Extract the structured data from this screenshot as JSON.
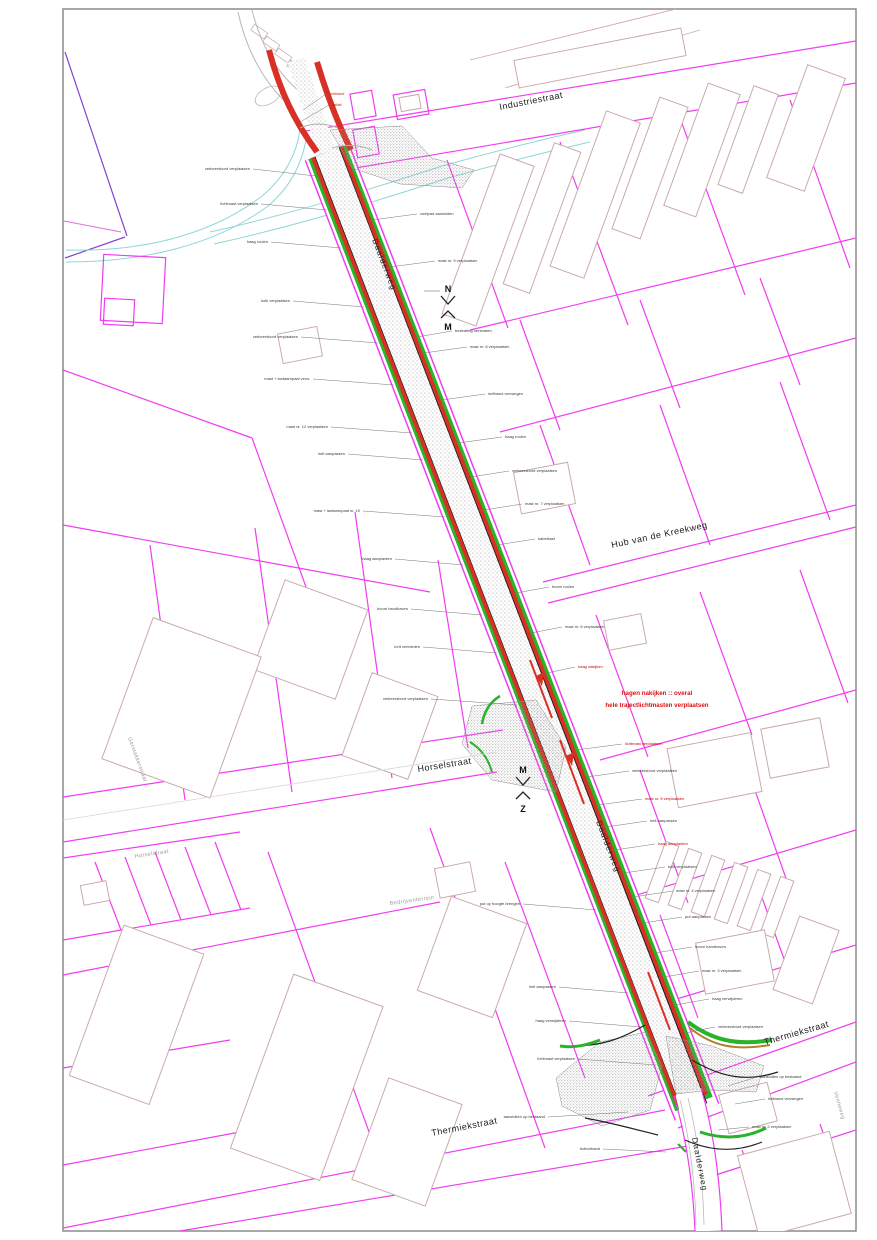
{
  "labels": {
    "industriestraat": "Industriestraat",
    "daalderweg": "Daalderweg",
    "hub_van_de_kreekweg": "Hub van de Kreekweg",
    "horselstraat": "Horselstraat",
    "horselstraat_small": "Horselstraat",
    "thermiekstraat_ne": "Thermiekstraat",
    "thermiekstraat_sw": "Thermiekstraat",
    "gerstakkerstraat": "Gerstakkerstraat",
    "bedrijventerrein": "Bedrijventerrein",
    "venneweg": "Venneweg"
  },
  "note": {
    "line1": "hagen nakijken :: overal",
    "line2": "hele trajectlichtmasten verplaatsen"
  },
  "markers": [
    {
      "top": "N",
      "bottom": "M"
    },
    {
      "top": "M",
      "bottom": "Z"
    }
  ],
  "colors": {
    "road_red": "#d93025",
    "parcel_magenta": "#f23cf2",
    "verge_green": "#2ab32a",
    "note_red": "#dd1111",
    "water_teal": "#8fd6d6",
    "building_outline": "#c9abab"
  },
  "annotations": [
    {
      "t": "verkeersbord verplaatsen",
      "x": 250,
      "y": 170,
      "lx": 316,
      "ly": 176,
      "a": "end"
    },
    {
      "t": "lichtmast verplaatsen",
      "x": 258,
      "y": 205,
      "lx": 327,
      "ly": 210,
      "a": "end"
    },
    {
      "t": "haag rooien",
      "x": 268,
      "y": 243,
      "lx": 341,
      "ly": 248,
      "a": "end"
    },
    {
      "t": "kolk verplaatsen",
      "x": 290,
      "y": 302,
      "lx": 364,
      "ly": 307,
      "a": "end"
    },
    {
      "t": "verkeersbord verplaatsen",
      "x": 298,
      "y": 338,
      "lx": 378,
      "ly": 343,
      "a": "end"
    },
    {
      "t": "mast + lantaarnpaal verw.",
      "x": 310,
      "y": 380,
      "lx": 394,
      "ly": 385,
      "a": "end"
    },
    {
      "t": "mast nr. 12 verplaatsen",
      "x": 328,
      "y": 428,
      "lx": 412,
      "ly": 433,
      "a": "end"
    },
    {
      "t": "inrit aanpassen",
      "x": 345,
      "y": 455,
      "lx": 423,
      "ly": 460,
      "a": "end"
    },
    {
      "t": "mast + lantaarnpaal nr. 10",
      "x": 360,
      "y": 512,
      "lx": 445,
      "ly": 517,
      "a": "end"
    },
    {
      "t": "haag aanplanten",
      "x": 392,
      "y": 560,
      "lx": 463,
      "ly": 565,
      "a": "end"
    },
    {
      "t": "boom handhaven",
      "x": 408,
      "y": 610,
      "lx": 482,
      "ly": 615,
      "a": "end"
    },
    {
      "t": "inrit verbreden",
      "x": 420,
      "y": 648,
      "lx": 497,
      "ly": 653,
      "a": "end"
    },
    {
      "t": "verkeersbord verplaatsen",
      "x": 428,
      "y": 700,
      "lx": 517,
      "ly": 705,
      "a": "end"
    },
    {
      "t": "put op hoogte brengen",
      "x": 520,
      "y": 905,
      "lx": 596,
      "ly": 910,
      "a": "end"
    },
    {
      "t": "inrit aanpassen",
      "x": 556,
      "y": 988,
      "lx": 628,
      "ly": 993,
      "a": "end"
    },
    {
      "t": "haag verwijderen",
      "x": 566,
      "y": 1022,
      "lx": 641,
      "ly": 1027,
      "a": "end"
    },
    {
      "t": "lichtmast verplaatsen",
      "x": 575,
      "y": 1060,
      "lx": 656,
      "ly": 1065,
      "a": "end"
    },
    {
      "t": "aansluiten op bestaand",
      "x": 545,
      "y": 1118,
      "lx": 628,
      "ly": 1112,
      "a": "end"
    },
    {
      "t": "trottoirband",
      "x": 600,
      "y": 1150,
      "lx": 666,
      "ly": 1152,
      "a": "end"
    },
    {
      "t": "inritband",
      "x": 329,
      "y": 95,
      "lx": 303,
      "ly": 110,
      "a": "start",
      "c": "#cc2200"
    },
    {
      "t": "asfalt",
      "x": 332,
      "y": 106,
      "lx": 300,
      "ly": 122,
      "a": "start",
      "c": "#cc2200"
    },
    {
      "t": "voetpad aansluiten",
      "x": 420,
      "y": 215,
      "lx": 372,
      "ly": 220,
      "a": "start"
    },
    {
      "t": "mast nr. 9 verplaatsen",
      "x": 438,
      "y": 262,
      "lx": 390,
      "ly": 267,
      "a": "start"
    },
    {
      "t": "bestrating herstraten",
      "x": 455,
      "y": 332,
      "lx": 417,
      "ly": 337,
      "a": "start"
    },
    {
      "t": "mast nr. 8 verplaatsen",
      "x": 470,
      "y": 348,
      "lx": 424,
      "ly": 353,
      "a": "start"
    },
    {
      "t": "inritband vervangen",
      "x": 488,
      "y": 395,
      "lx": 442,
      "ly": 400,
      "a": "start"
    },
    {
      "t": "haag rooien",
      "x": 505,
      "y": 438,
      "lx": 458,
      "ly": 443,
      "a": "start"
    },
    {
      "t": "verkeersbord verplaatsen",
      "x": 512,
      "y": 472,
      "lx": 471,
      "ly": 477,
      "a": "start"
    },
    {
      "t": "mast nr. 7 verplaatsen",
      "x": 525,
      "y": 505,
      "lx": 484,
      "ly": 510,
      "a": "start"
    },
    {
      "t": "kabelkast",
      "x": 538,
      "y": 540,
      "lx": 497,
      "ly": 545,
      "a": "start"
    },
    {
      "t": "boom rooien",
      "x": 552,
      "y": 588,
      "lx": 516,
      "ly": 593,
      "a": "start"
    },
    {
      "t": "mast nr. 6 verplaatsen",
      "x": 565,
      "y": 628,
      "lx": 531,
      "ly": 633,
      "a": "start"
    },
    {
      "t": "haag nakijken",
      "x": 578,
      "y": 668,
      "lx": 547,
      "ly": 673,
      "a": "start",
      "c": "#cc0000"
    },
    {
      "t": "lichtmast verplaatsen",
      "x": 625,
      "y": 745,
      "lx": 576,
      "ly": 750,
      "a": "start",
      "c": "#cc0000"
    },
    {
      "t": "verkeersbord verplaatsen",
      "x": 632,
      "y": 772,
      "lx": 587,
      "ly": 777,
      "a": "start"
    },
    {
      "t": "mast nr. 5 verplaatsen",
      "x": 645,
      "y": 800,
      "lx": 598,
      "ly": 805,
      "a": "start",
      "c": "#cc0000"
    },
    {
      "t": "inrit aanpassen",
      "x": 650,
      "y": 822,
      "lx": 606,
      "ly": 827,
      "a": "start"
    },
    {
      "t": "haag aanplanten",
      "x": 658,
      "y": 845,
      "lx": 615,
      "ly": 850,
      "a": "start",
      "c": "#cc0000"
    },
    {
      "t": "kolk verplaatsen",
      "x": 668,
      "y": 868,
      "lx": 624,
      "ly": 873,
      "a": "start"
    },
    {
      "t": "mast nr. 4 verplaatsen",
      "x": 676,
      "y": 892,
      "lx": 633,
      "ly": 897,
      "a": "start"
    },
    {
      "t": "put aanpassen",
      "x": 685,
      "y": 918,
      "lx": 643,
      "ly": 923,
      "a": "start"
    },
    {
      "t": "boom handhaven",
      "x": 695,
      "y": 948,
      "lx": 655,
      "ly": 953,
      "a": "start"
    },
    {
      "t": "mast nr. 3 verplaatsen",
      "x": 702,
      "y": 972,
      "lx": 664,
      "ly": 977,
      "a": "start"
    },
    {
      "t": "haag verwijderen",
      "x": 712,
      "y": 1000,
      "lx": 675,
      "ly": 1005,
      "a": "start"
    },
    {
      "t": "verkeersbord verplaatsen",
      "x": 718,
      "y": 1028,
      "lx": 685,
      "ly": 1033,
      "a": "start"
    },
    {
      "t": "aansluiten op bestaand",
      "x": 760,
      "y": 1078,
      "lx": 728,
      "ly": 1086,
      "a": "start"
    },
    {
      "t": "inritband vervangen",
      "x": 768,
      "y": 1100,
      "lx": 735,
      "ly": 1104,
      "a": "start"
    },
    {
      "t": "mast nr. 2 verplaatsen",
      "x": 752,
      "y": 1128,
      "lx": 718,
      "ly": 1130,
      "a": "start"
    }
  ]
}
